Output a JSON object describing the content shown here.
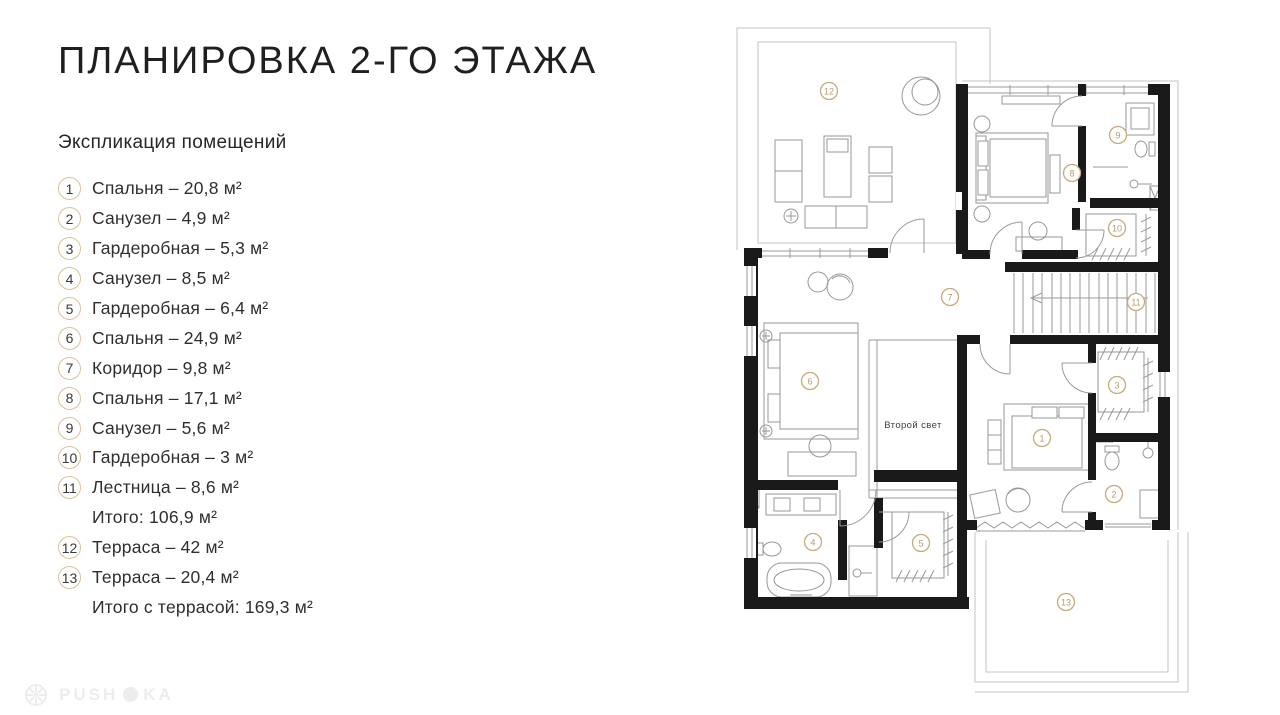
{
  "header": {
    "title": "ПЛАНИРОВКА 2-ГО ЭТАЖА",
    "legend_heading": "Экспликация помещений"
  },
  "legend": {
    "rows": [
      {
        "num": "1",
        "label": "Спальня – 20,8 м²"
      },
      {
        "num": "2",
        "label": "Санузел – 4,9 м²"
      },
      {
        "num": "3",
        "label": "Гардеробная – 5,3 м²"
      },
      {
        "num": "4",
        "label": "Санузел – 8,5 м²"
      },
      {
        "num": "5",
        "label": "Гардеробная – 6,4 м²"
      },
      {
        "num": "6",
        "label": "Спальня – 24,9 м²"
      },
      {
        "num": "7",
        "label": "Коридор – 9,8 м²"
      },
      {
        "num": "8",
        "label": "Спальня – 17,1 м²"
      },
      {
        "num": "9",
        "label": "Санузел – 5,6 м²"
      },
      {
        "num": "10",
        "label": "Гардеробная – 3 м²"
      },
      {
        "num": "11",
        "label": "Лестница – 8,6 м²"
      },
      {
        "num": "",
        "label": "Итого: 106,9 м²"
      },
      {
        "num": "12",
        "label": "Терраса – 42 м²"
      },
      {
        "num": "13",
        "label": "Терраса – 20,4 м²"
      },
      {
        "num": "",
        "label": "Итого с террасой: 169,3 м²"
      }
    ]
  },
  "plan": {
    "second_light_label": "Второй свет",
    "markers": [
      "1",
      "2",
      "3",
      "4",
      "5",
      "6",
      "7",
      "8",
      "9",
      "10",
      "11",
      "12",
      "13"
    ]
  },
  "watermark": {
    "left": "PUSH",
    "right": "KA"
  },
  "colors": {
    "legend_circle": "#d9c39a",
    "plan_marker": "#b79d6f",
    "wall": "#1a1a1a",
    "thin_line": "#9a9a9a"
  }
}
